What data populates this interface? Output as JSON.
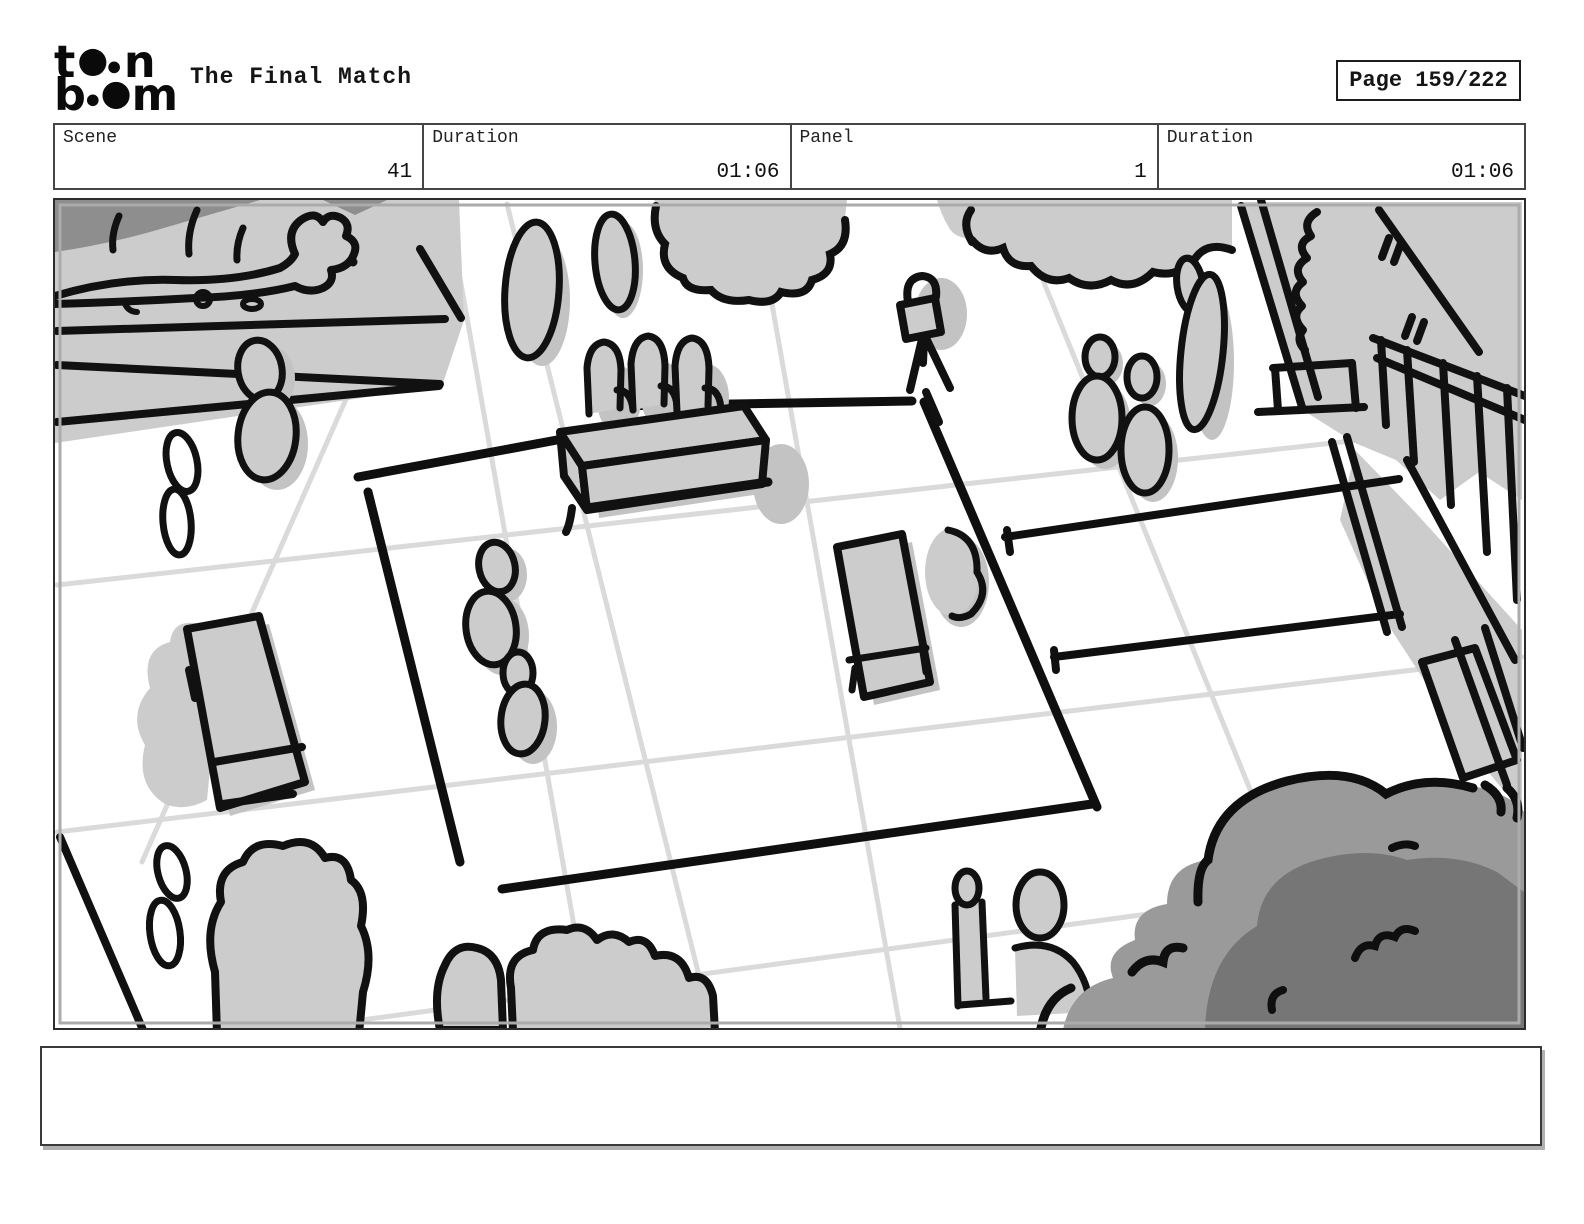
{
  "header": {
    "logo": {
      "line1_start": "t",
      "line1_end": "n",
      "line2_start": "b",
      "line2_end": "m"
    },
    "title": "The Final Match",
    "page_label": "Page 159/222"
  },
  "info_row": {
    "cells": [
      {
        "label": "Scene",
        "value": "41"
      },
      {
        "label": "Duration",
        "value": "01:06"
      },
      {
        "label": "Panel",
        "value": "1"
      },
      {
        "label": "Duration",
        "value": "01:06"
      }
    ]
  },
  "caption": {
    "text": ""
  },
  "colors": {
    "ink": "#111111",
    "fill_light_gray": "#cccccc",
    "shadow_gray": "#c3c3c3",
    "grid_gray": "#dadada",
    "dark_corner_gray": "#8e8e8e",
    "bush_dark_outer": "#9a9a9a",
    "bush_dark_inner": "#767676"
  }
}
